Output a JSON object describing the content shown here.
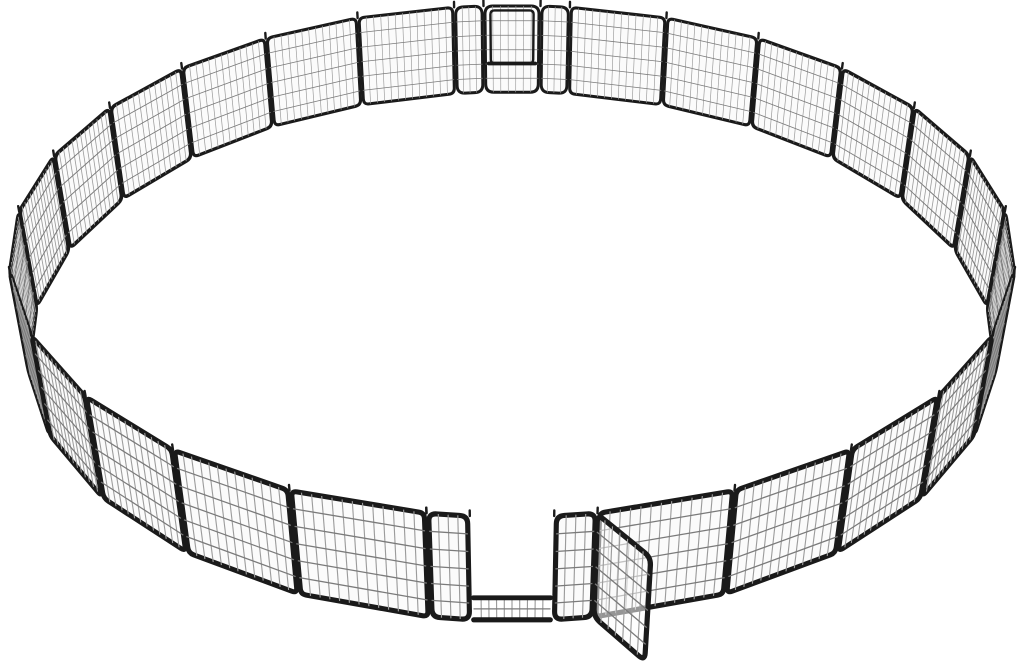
{
  "figure": {
    "subject": "Heavy-duty black metal dog playpen: wire-mesh fence panels connected in a large circle on a white background, rear walk-through gate closed, front gate door swung open",
    "style": "product-photo"
  },
  "scene": {
    "viewport": {
      "w": 1024,
      "h": 667,
      "bbox": [
        10,
        6,
        1014,
        661
      ]
    },
    "colors": {
      "background": "#ffffff",
      "frame": "#1a1a1a",
      "mesh_v": "#9c9c9c",
      "mesh_h": "#7a7a7a",
      "fill": "#fbfbfb",
      "leaf_fill_opacity": 0.55
    },
    "ring": {
      "regular_panels_per_half": 12,
      "panel_height": 1.12,
      "gap": 0.015
    },
    "gate": {
      "strip_w": 0.3,
      "door_w": 0.58,
      "rail_frac": 0.22,
      "kick_cols": 9,
      "open_swing_deg": 62,
      "door_inner": {
        "left": 0.1,
        "right": 0.9,
        "top": 0.95,
        "bottom": 0.34
      }
    },
    "mesh": {
      "rows": 5,
      "panel_cols": 12,
      "strip_cols": 3,
      "door_cols": 6
    },
    "camera": {
      "dist": 3.5,
      "height": 2.6,
      "look_z": 0.5
    },
    "pins": {
      "length": 5.5,
      "width": 2.4
    }
  }
}
